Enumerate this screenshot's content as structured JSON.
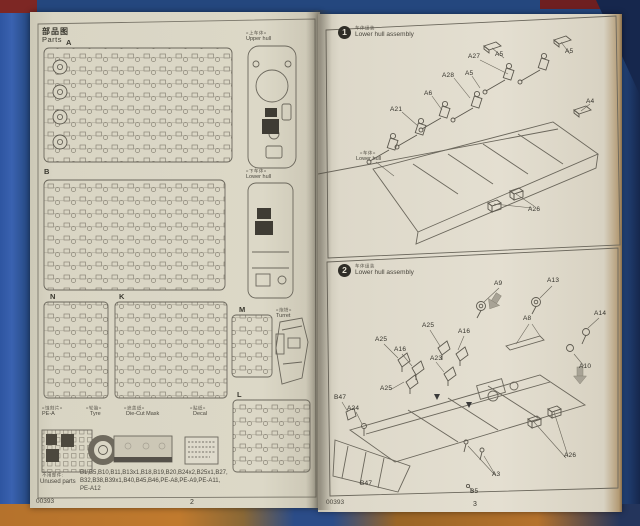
{
  "colors": {
    "cover_blue": "#2e55a1",
    "cover_navy": "#24477e",
    "maroon_corner": "#7d2724",
    "orange_edge": "#b5722c",
    "paper": "#dcd8c7",
    "line_art": "#5c584e"
  },
  "left_page": {
    "title_cn": "部品图",
    "title_en": "Parts",
    "sprues": {
      "a": "A",
      "b": "B",
      "n": "N",
      "k": "K",
      "m": "M",
      "l": "L"
    },
    "views": {
      "upper_hull": {
        "cn": "«上车体»",
        "en": "Upper hull"
      },
      "lower_hull": {
        "cn": "«下车体»",
        "en": "Lower hull"
      },
      "turret": {
        "cn": "«炮塔»",
        "en": "Turret"
      }
    },
    "bottom_items": {
      "pe": {
        "cn": "«蚀刻片»",
        "en": "PE-A"
      },
      "tyre": {
        "cn": "«轮胎»",
        "en": "Tyre"
      },
      "diecut": {
        "cn": "«遮盖纸»",
        "en": "Die-Cut Mask"
      },
      "decal": {
        "cn": "«贴纸»",
        "en": "Decal"
      }
    },
    "unused": {
      "label_cn": "不用部件:",
      "label_en": "Unused parts",
      "line1": "B1,B5,B10,B11,B13x1,B18,B19,B20,B24x2,B25x1,B27,",
      "line2": "B32,B38,B39x1,B40,B45,B46,PE-A8,PE-A9,PE-A11,",
      "line3": "PE-A12"
    },
    "footer_code": "00393",
    "page_number": "2"
  },
  "right_page": {
    "step1": {
      "number": "1",
      "title_cn": "车体组装",
      "title_en": "Lower hull assembly",
      "labels": [
        "A27",
        "A5",
        "A5",
        "A28",
        "A5",
        "A6",
        "A21",
        "A4",
        "A26"
      ],
      "note_cn": "«车体»",
      "note_en": "Lower hull"
    },
    "step2": {
      "number": "2",
      "title_cn": "车体组装",
      "title_en": "Lower hull assembly",
      "labels": [
        "A9",
        "A13",
        "A8",
        "A14",
        "A10",
        "A25",
        "A16",
        "A25",
        "A16",
        "A23",
        "A25",
        "B47",
        "A24",
        "A3",
        "B5",
        "B47",
        "A26"
      ]
    },
    "footer_code": "00393",
    "page_number": "3"
  }
}
